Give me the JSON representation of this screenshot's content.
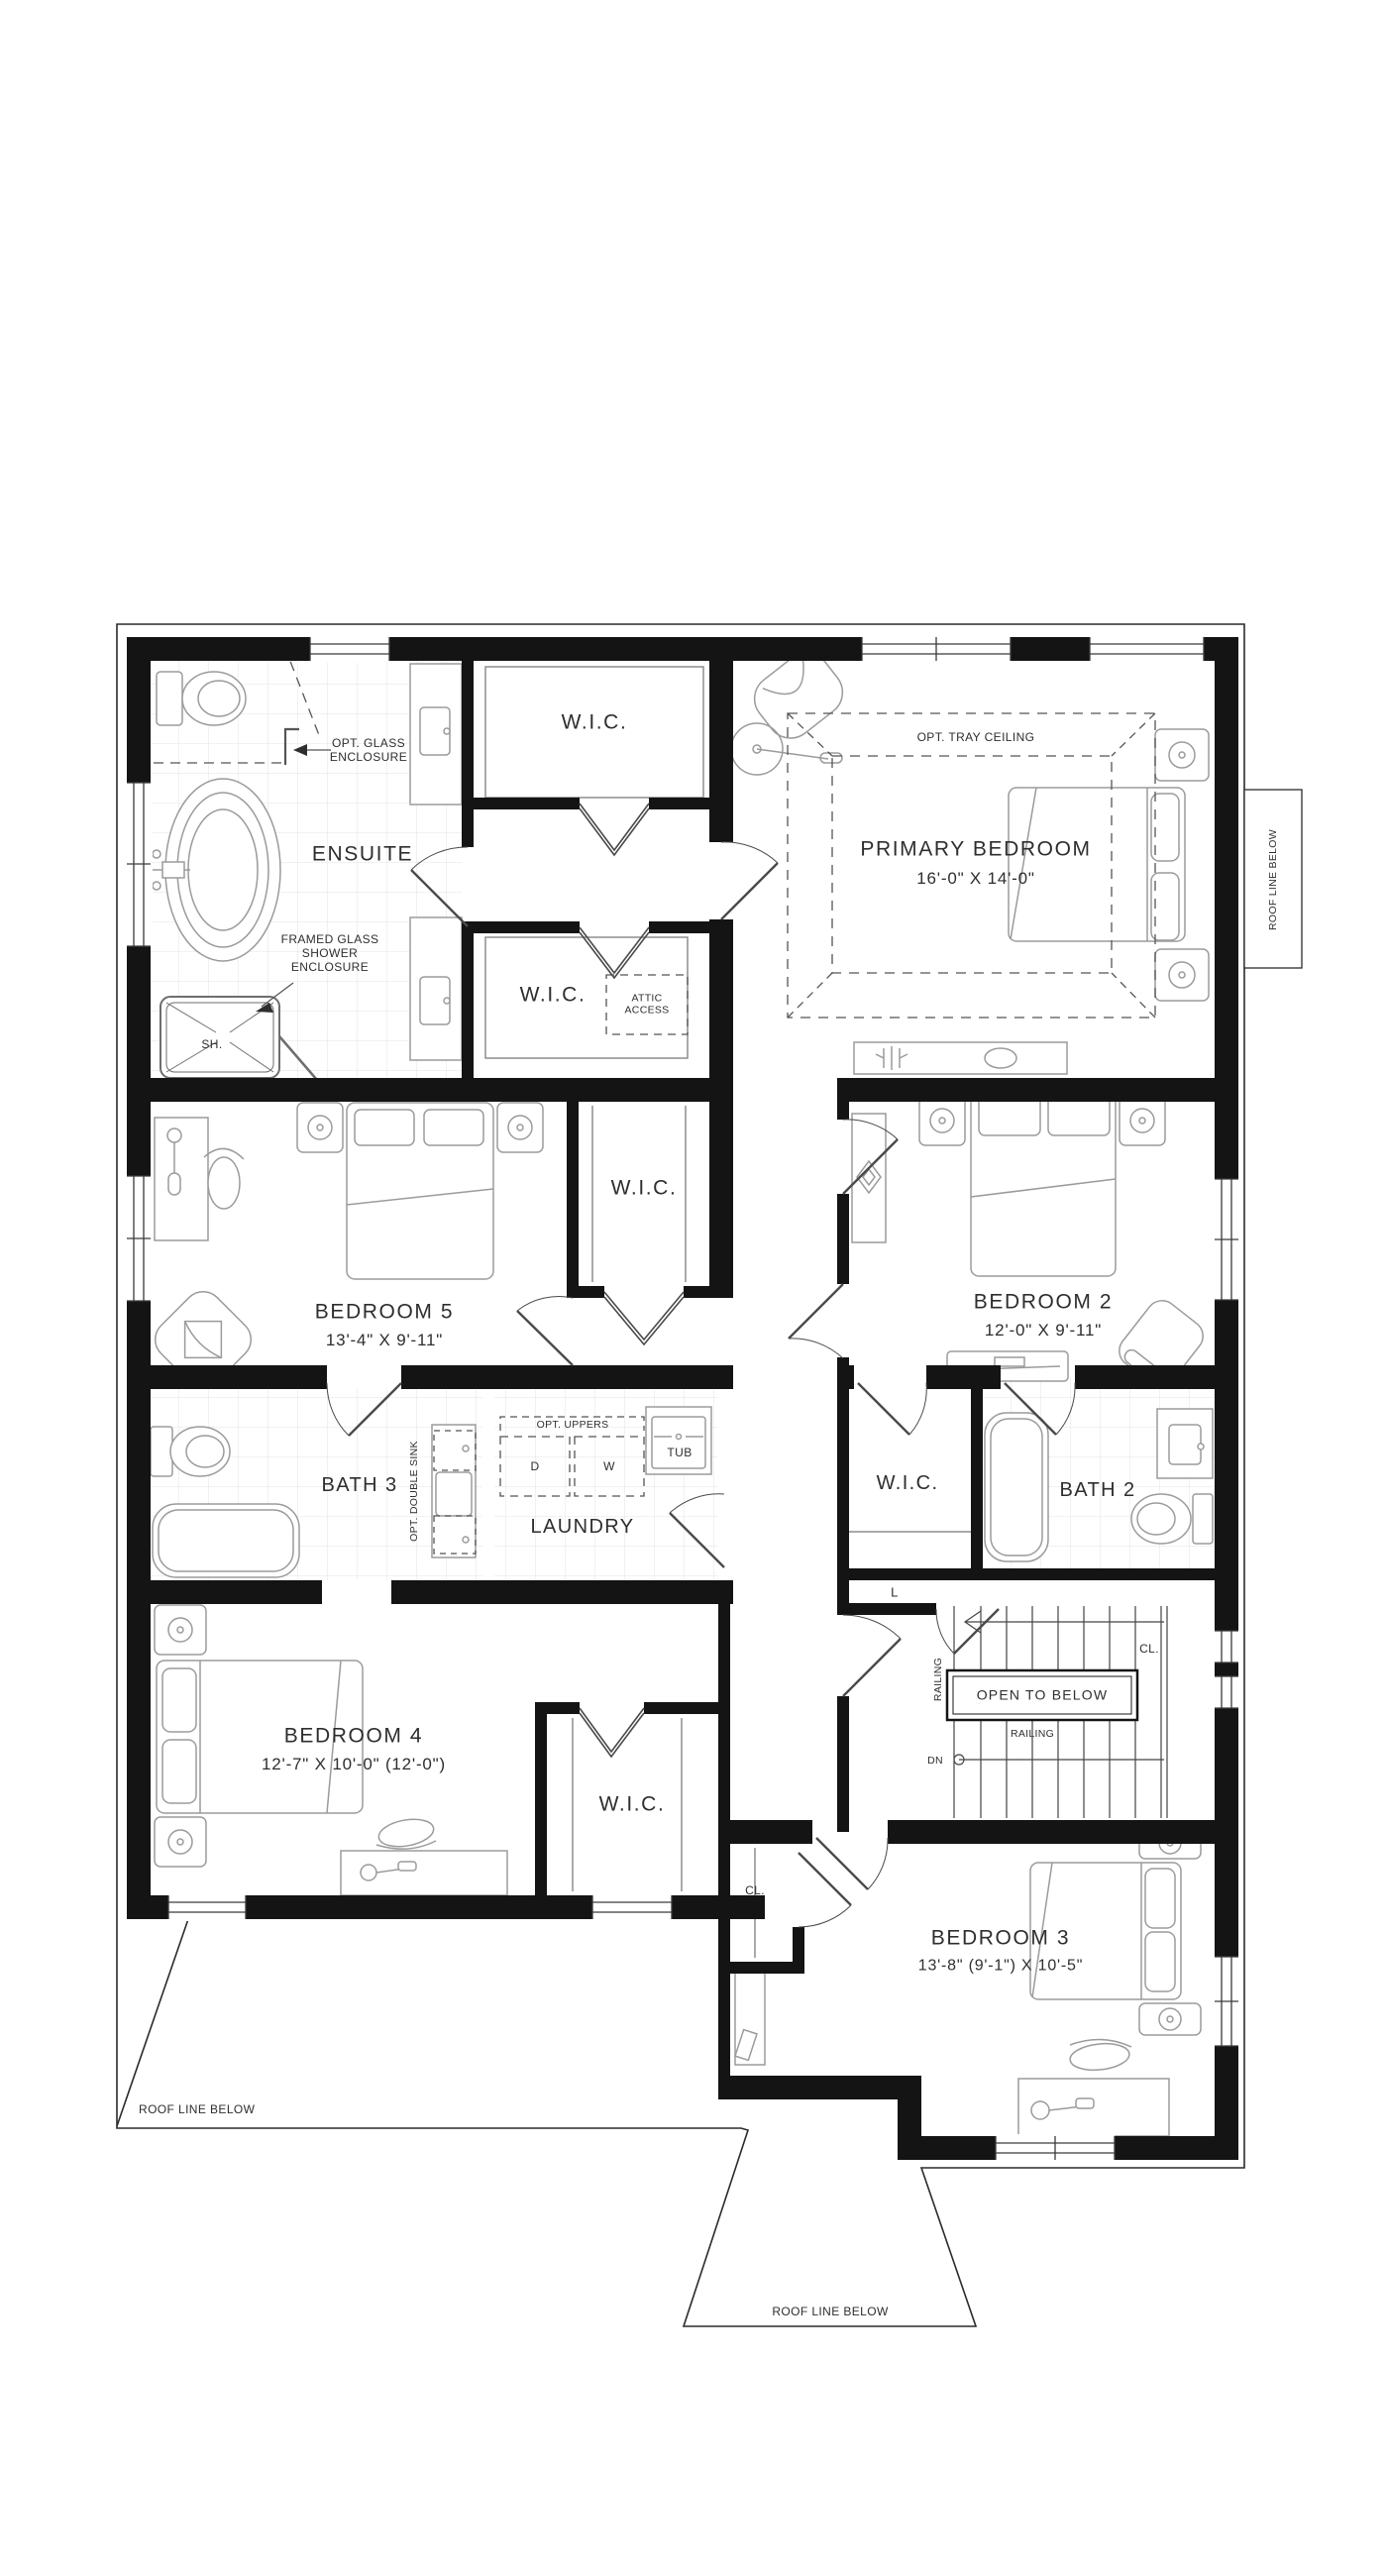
{
  "page": {
    "background": "#ffffff"
  },
  "colors": {
    "wall": "#141414",
    "furniture": "#9b9b9b",
    "text": "#2e2e2e",
    "thin_line": "#2b2b2b"
  },
  "rooms": {
    "ensuite": {
      "name": "ENSUITE"
    },
    "wic": {
      "name": "W.I.C."
    },
    "primary": {
      "name": "PRIMARY BEDROOM",
      "dims": "16'-0\" X 14'-0\""
    },
    "bedroom5": {
      "name": "BEDROOM 5",
      "dims": "13'-4\" X 9'-11\""
    },
    "bedroom2": {
      "name": "BEDROOM 2",
      "dims": "12'-0\" X 9'-11\""
    },
    "bedroom4": {
      "name": "BEDROOM 4",
      "dims": "12'-7\" X 10'-0\" (12'-0\")"
    },
    "bedroom3": {
      "name": "BEDROOM 3",
      "dims": "13'-8\" (9'-1\") X 10'-5\""
    },
    "bath3": {
      "name": "BATH 3"
    },
    "bath2": {
      "name": "BATH 2"
    },
    "laundry": {
      "name": "LAUNDRY"
    },
    "linen": {
      "name": "L"
    },
    "closet": {
      "name": "CL."
    }
  },
  "annotations": {
    "opt_glass": "OPT. GLASS\nENCLOSURE",
    "framed_glass": "FRAMED GLASS\nSHOWER\nENCLOSURE",
    "shower": "SH.",
    "tray_ceiling": "OPT. TRAY CEILING",
    "attic": "ATTIC\nACCESS",
    "double_sink": "OPT. DOUBLE SINK",
    "uppers": "OPT. UPPERS",
    "dryer": "D",
    "washer": "W",
    "tub": "TUB",
    "open_to_below": "OPEN TO BELOW",
    "railing": "RAILING",
    "down": "DN",
    "roof_line": "ROOF LINE BELOW"
  }
}
